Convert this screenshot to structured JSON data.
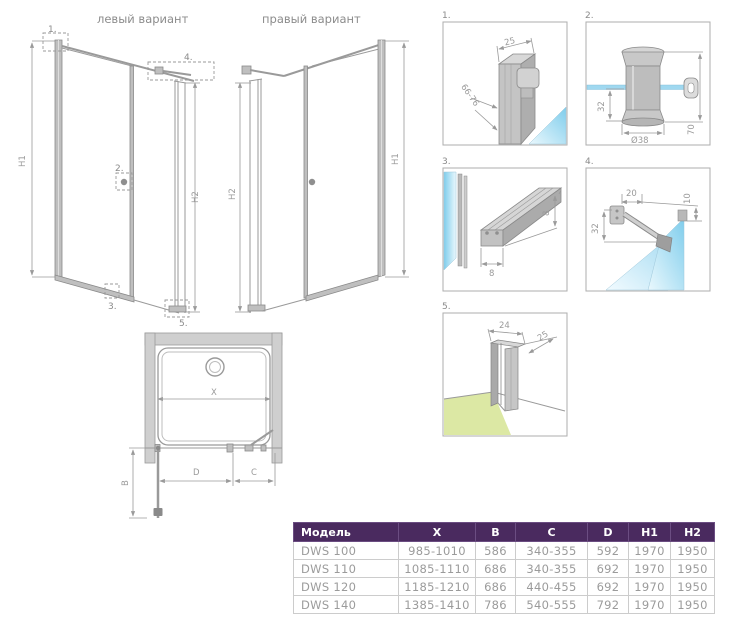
{
  "titles": {
    "left_variant": "левый вариант",
    "right_variant": "правый вариант"
  },
  "dim_labels": {
    "h1": "H1",
    "h2": "H2",
    "x": "X",
    "b": "B",
    "c": "C",
    "d": "D"
  },
  "details": [
    {
      "number": "1.",
      "dim_width": "25",
      "dim_depth": "66-76"
    },
    {
      "number": "2.",
      "dim_offset": "32",
      "dim_diameter": "Ø38",
      "dim_height": "70"
    },
    {
      "number": "3.",
      "dim_width": "8",
      "dim_height": "8"
    },
    {
      "number": "4.",
      "dim_width": "20",
      "dim_depth": "32",
      "dim_gap": "10"
    },
    {
      "number": "5.",
      "dim_width": "24",
      "dim_depth": "25"
    }
  ],
  "table": {
    "headers": [
      "Модель",
      "X",
      "B",
      "C",
      "D",
      "H1",
      "H2"
    ],
    "rows": [
      [
        "DWS 100",
        "985-1010",
        "586",
        "340-355",
        "592",
        "1970",
        "1950"
      ],
      [
        "DWS 110",
        "1085-1110",
        "686",
        "340-355",
        "692",
        "1970",
        "1950"
      ],
      [
        "DWS 120",
        "1185-1210",
        "686",
        "440-455",
        "692",
        "1970",
        "1950"
      ],
      [
        "DWS 140",
        "1385-1410",
        "786",
        "540-555",
        "792",
        "1970",
        "1950"
      ]
    ]
  },
  "colors": {
    "table_header_bg": "#4a2a5f",
    "table_text": "#9b9b9b",
    "line_gray": "#9a9a9a",
    "glass_blue": "#8fd4f0",
    "floor_green": "#dce8a4"
  }
}
